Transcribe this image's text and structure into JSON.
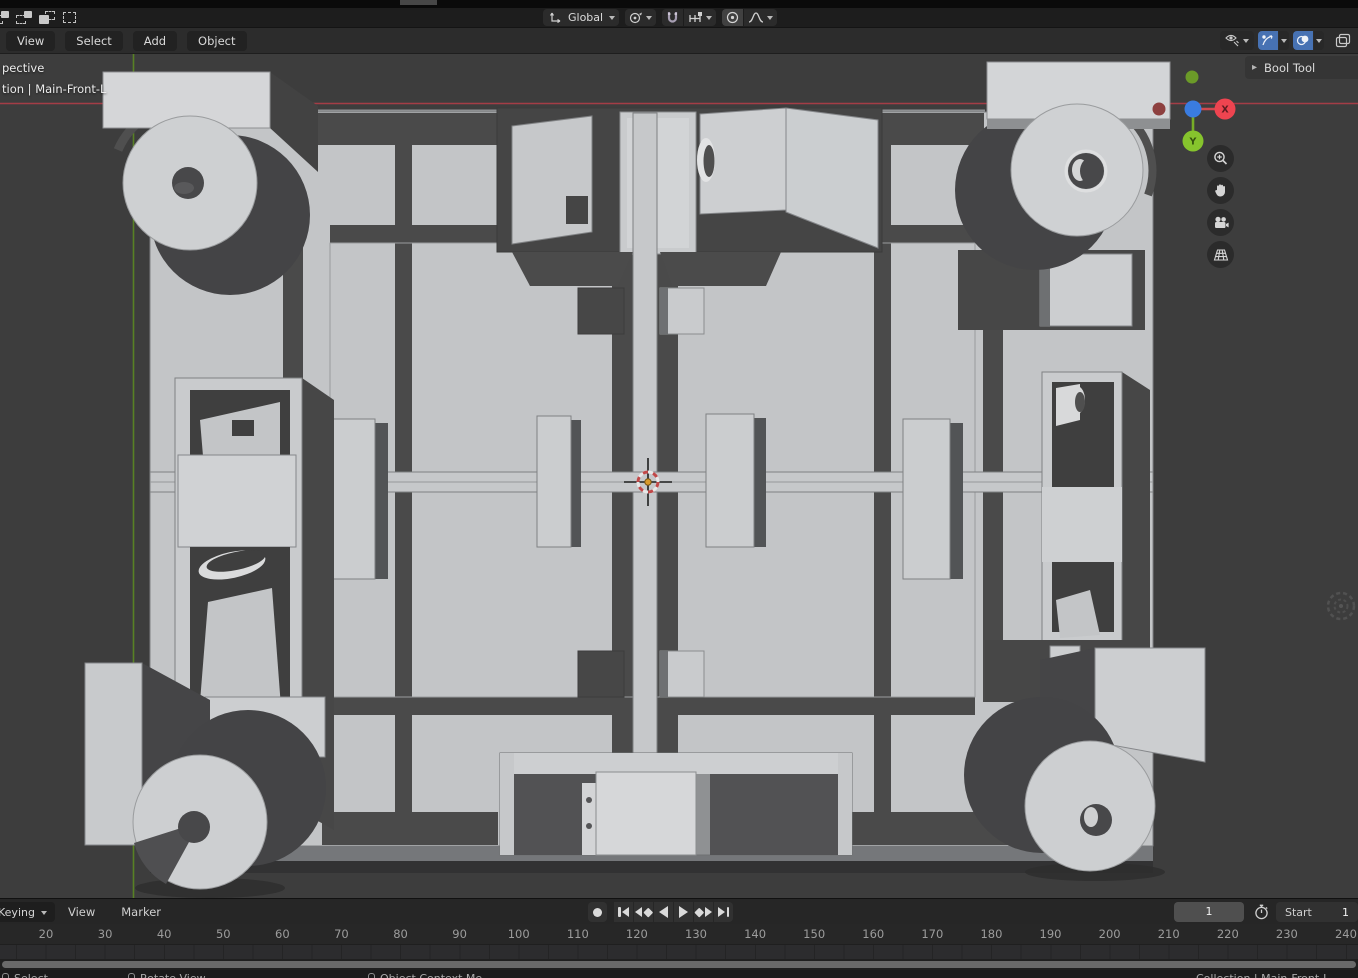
{
  "tool_settings": {
    "select_mode_icons": [
      "select-new-icon",
      "select-extend-icon",
      "select-subtract-icon",
      "select-intersect-icon"
    ],
    "orientation": {
      "icon": "transform-orientation-icon",
      "value": "Global"
    },
    "pivot": {
      "icon": "pivot-point-icon"
    },
    "snap": {
      "magnet_icon": "snap-magnet-icon",
      "target_icon": "snap-increment-icon"
    },
    "proportional": {
      "icon": "proportional-editing-icon",
      "falloff_icon": "falloff-smooth-icon"
    }
  },
  "viewport_header": {
    "menus": [
      "View",
      "Select",
      "Add",
      "Object"
    ],
    "right_icons": [
      "object-type-visibility-icon",
      "gizmos-icon",
      "overlays-icon",
      "xray-icon"
    ],
    "accent_color": "#4772b3"
  },
  "viewport": {
    "overlay": {
      "line1": "pective",
      "line2": "tion | Main-Front-L"
    },
    "sidebar_tab": {
      "arrow": "▸",
      "label": "Bool Tool"
    },
    "nav_gizmo": {
      "x_label": "X",
      "y_label": "Y",
      "colors": {
        "x": "#ee4450",
        "y": "#86c42d",
        "z": "#3a7ce0",
        "neg_x": "#8d403f",
        "neg_y": "#6b9a28"
      }
    },
    "nav_buttons": [
      "zoom-icon",
      "pan-hand-icon",
      "camera-view-icon",
      "toggle-perspective-icon"
    ],
    "axis_colors": {
      "x_line": "#b03e48",
      "y_line": "#5d8e20"
    },
    "cursor_center_color": "#d99a2b",
    "background": "#3d3d3d"
  },
  "timeline": {
    "keying_label": "Keying",
    "view_label": "View",
    "marker_label": "Marker",
    "record": {
      "name": "record-button",
      "parts": [
        "dot"
      ]
    },
    "transport": [
      {
        "name": "jump-to-start-button",
        "parts": [
          "bar",
          "tri-left"
        ]
      },
      {
        "name": "prev-keyframe-button",
        "parts": [
          "tri-left",
          "diamond"
        ]
      },
      {
        "name": "play-reverse-button",
        "parts": [
          "tri-left-big"
        ]
      },
      {
        "name": "play-button",
        "parts": [
          "tri-right-big"
        ]
      },
      {
        "name": "next-keyframe-button",
        "parts": [
          "diamond",
          "tri-right"
        ]
      },
      {
        "name": "jump-to-end-button",
        "parts": [
          "tri-right",
          "bar"
        ]
      }
    ],
    "current_frame": "1",
    "stopwatch_icon": "preview-range-icon",
    "start_label": "Start",
    "start_value": "1",
    "ruler_labels": [
      20,
      30,
      40,
      50,
      60,
      70,
      80,
      90,
      100,
      110,
      120,
      130,
      140,
      150,
      160,
      170,
      180,
      190,
      200,
      210,
      220,
      230,
      240
    ]
  },
  "status_bar": {
    "items": [
      "Select",
      "Rotate View",
      "Object Context Me"
    ],
    "right_text": "Collection | Main-Front-L"
  },
  "colors": {
    "accent": "#4772b3",
    "viewport_bg": "#3d3d3d",
    "header_bg": "#2c2c2c",
    "topbar_bg": "#1d1d1d"
  }
}
